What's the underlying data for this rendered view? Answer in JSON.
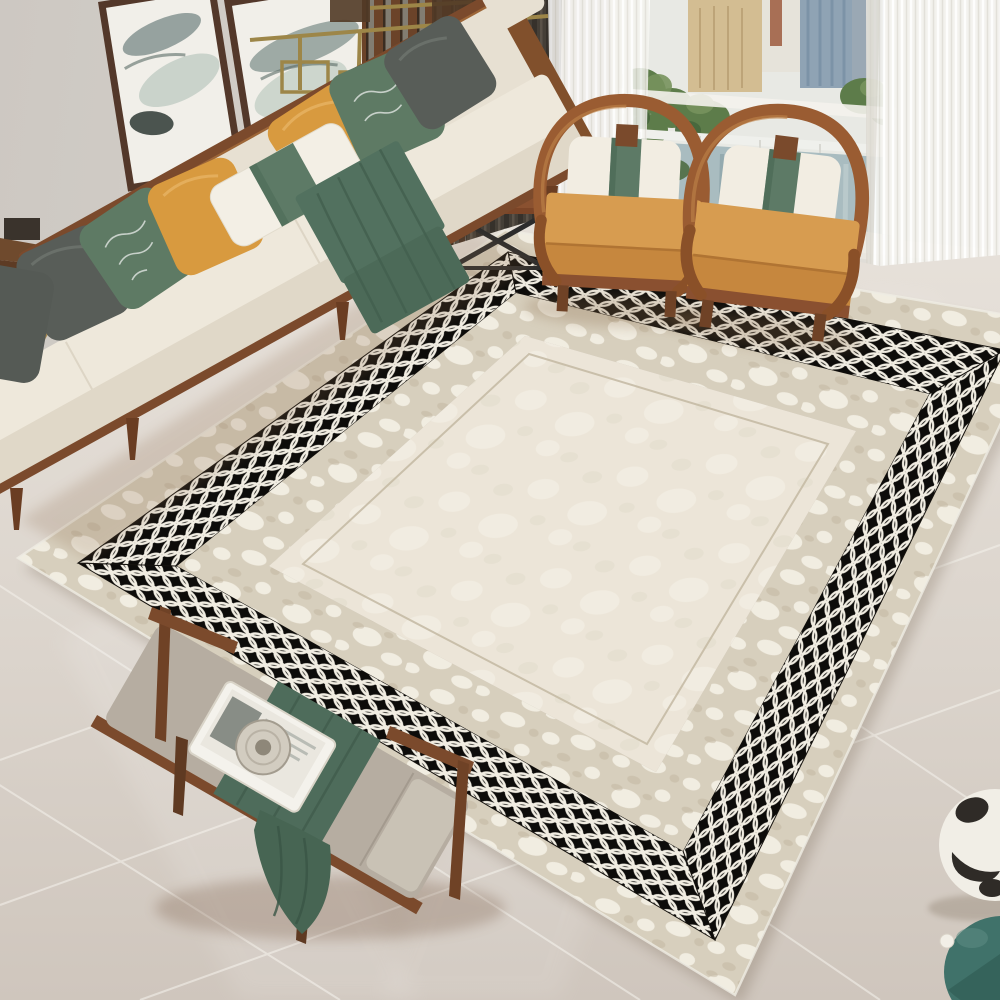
{
  "scene": {
    "title": "Modern living room photo: cream area rug with black and white oval-lattice border, beige sofa with green and mustard pillows, two curved-arm wooden armchairs, upholstered bench with green runner, window with city and river view",
    "setting": "living room interior, oblique top-down view",
    "objects": [
      "two ink-wash framed paintings",
      "wood slat partition",
      "brass linear chandelier",
      "dark drape",
      "white sheer curtains",
      "window with buildings, trees and river view",
      "cream fabric sofa with walnut frame",
      "seven throw pillows",
      "green throw blanket",
      "wooden side table with white drum lamp and round disc decor",
      "two horseshoe-arm wooden armchairs with camel cushions and green-band bolsters",
      "area rug with distressed beige borders and black lattice band",
      "wooden bench with gray cushion, white tray, magazine, plate and green runner",
      "white vase with black spots",
      "teal gourd vase",
      "glossy large-tile marble floor"
    ]
  },
  "counts": {
    "paintings": 2,
    "sofa_pillows": 7,
    "armchairs": 2,
    "rug_bands": 4
  },
  "palette": {
    "wall": "#d2cec8",
    "floor_light": "#e3ddd6",
    "floor_dark": "#cfc7bf",
    "grout": "#f3f0ea",
    "rug_field": "#ebe4d6",
    "rug_border_beige": "#d7cfbd",
    "rug_lattice_black": "#0d0c0a",
    "rug_lattice_white": "#f1ede2",
    "sofa_fabric": "#e9e2d4",
    "walnut_wood": "#7b4a2c",
    "pillow_mustard": "#d89a3f",
    "pillow_green": "#5e7a64",
    "pillow_gray": "#585d58",
    "throw_green": "#50705e",
    "armchair_camel": "#d79c50",
    "dark_drape": "#453f37",
    "sheer_white": "#f4f3ef",
    "brass": "#9d8648",
    "trees": "#5d7c4a",
    "water": "#a9bcc0",
    "vase_teal": "#40726a"
  },
  "rug": {
    "bands_outer_to_inner": [
      "distressed beige outer border",
      "black band with white interlocking oval lattice",
      "distressed beige inner border",
      "plain cream field with thin keyline"
    ]
  }
}
